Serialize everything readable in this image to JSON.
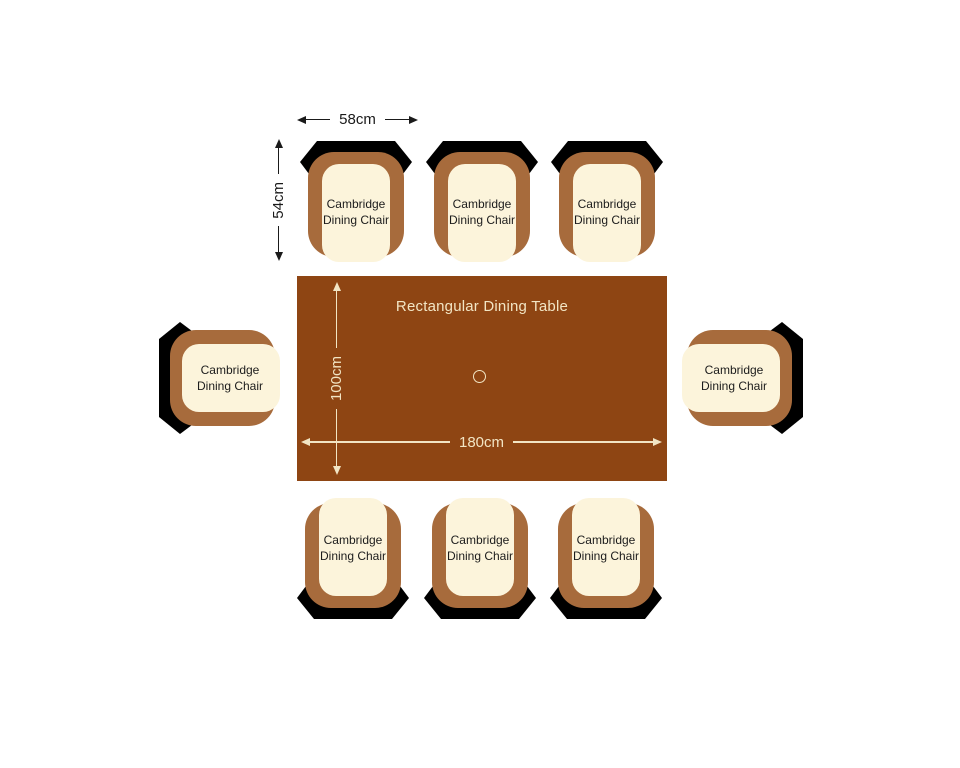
{
  "diagram": {
    "table": {
      "title": "Rectangular Dining Table",
      "length_label": "180cm",
      "depth_label": "100cm"
    },
    "chair_dimensions": {
      "width_label": "58cm",
      "depth_label": "54cm"
    },
    "chairs": [
      {
        "position": "top-left",
        "label": "Cambridge Dining Chair"
      },
      {
        "position": "top-center",
        "label": "Cambridge Dining Chair"
      },
      {
        "position": "top-right",
        "label": "Cambridge Dining Chair"
      },
      {
        "position": "left",
        "label": "Cambridge Dining Chair"
      },
      {
        "position": "right",
        "label": "Cambridge Dining Chair"
      },
      {
        "position": "bottom-left",
        "label": "Cambridge Dining Chair"
      },
      {
        "position": "bottom-center",
        "label": "Cambridge Dining Chair"
      },
      {
        "position": "bottom-right",
        "label": "Cambridge Dining Chair"
      }
    ],
    "colors": {
      "table_brown": "#8E4513",
      "chair_brown": "#A76B3C",
      "cushion_cream": "#FCF4DB",
      "table_text_cream": "#F2E5C4",
      "dimension_text_black": "#1A1A1A",
      "background": "#FFFFFF"
    }
  }
}
